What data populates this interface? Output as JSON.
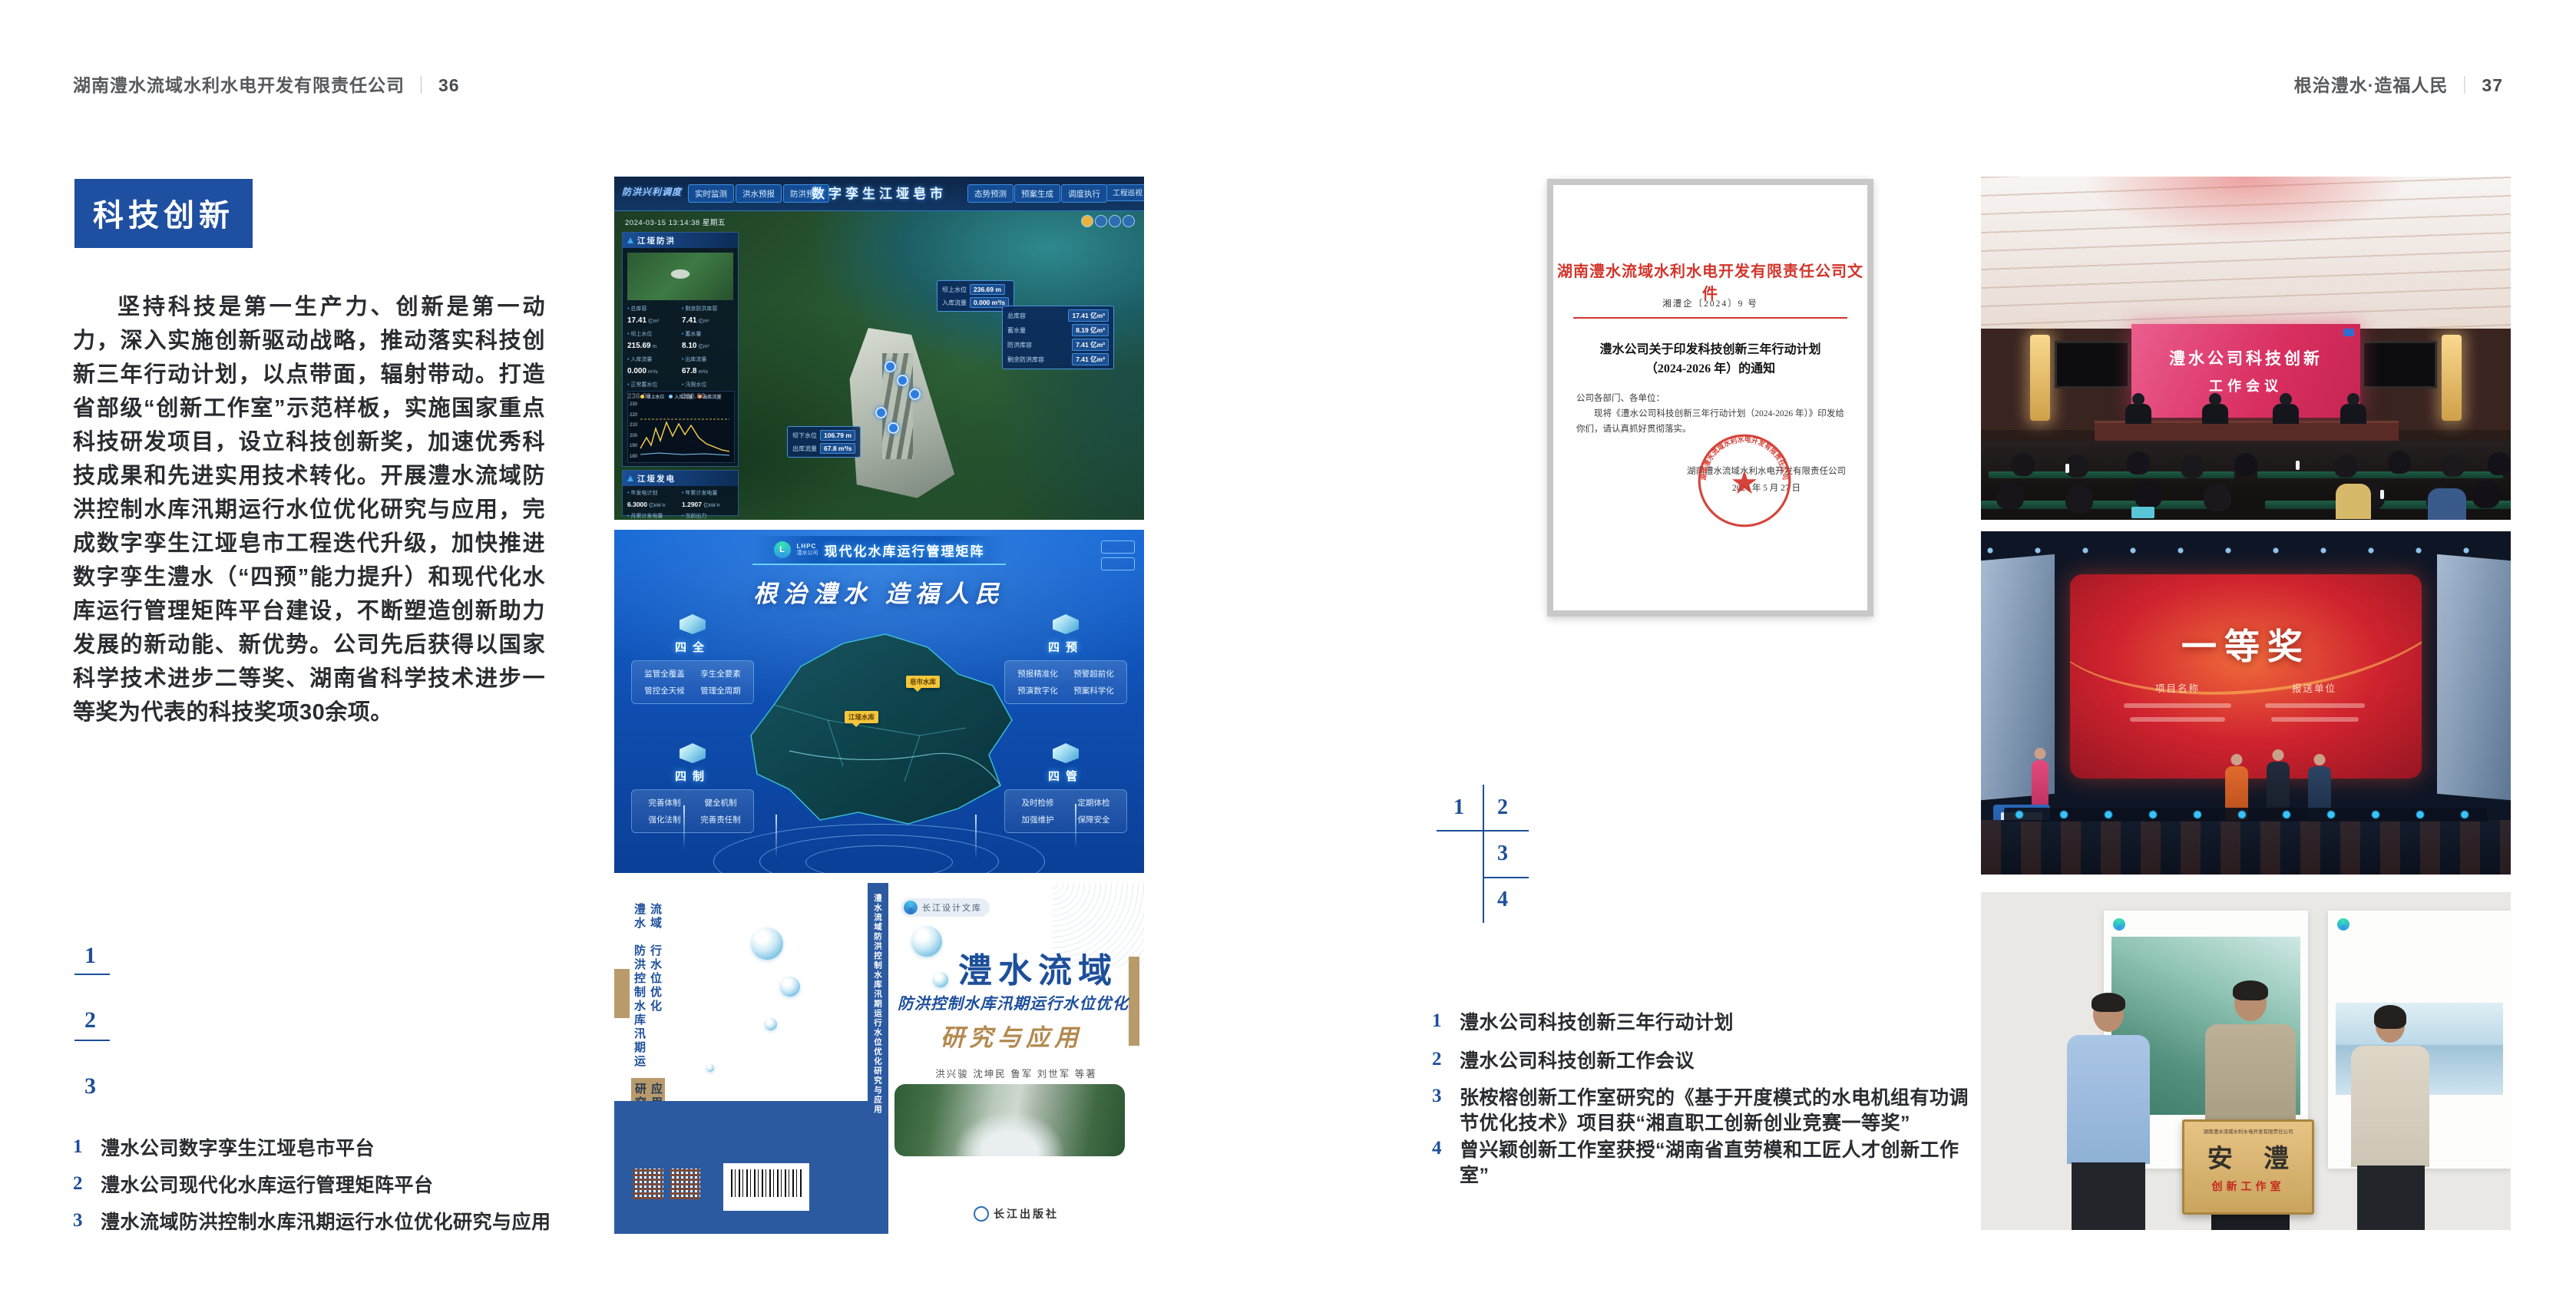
{
  "colors": {
    "accent_blue": "#1d4e99",
    "badge_blue": "#1e4fa0",
    "text_dark": "#2b2c31",
    "header_gray": "#58595b",
    "doc_red": "#d2352b",
    "gold": "#d8b26d"
  },
  "left_page": {
    "header": {
      "text": "湖南澧水流域水利水电开发有限责任公司",
      "sep": "｜",
      "page": "36"
    },
    "badge": "科技创新",
    "body": "坚持科技是第一生产力、创新是第一动力，深入实施创新驱动战略，推动落实科技创新三年行动计划，以点带面，辐射带动。打造省部级“创新工作室”示范样板，实施国家重点科技研发项目，设立科技创新奖，加速优秀科技成果和先进实用技术转化。开展澧水流域防洪控制水库汛期运行水位优化研究与应用，完成数字孪生江垭皂市工程迭代升级，加快推进数字孪生澧水（“四预”能力提升）和现代化水库运行管理矩阵平台建设，不断塑造创新助力发展的新动能、新优势。公司先后获得以国家科学技术进步二等奖、湖南省科学技术进步一等奖为代表的科技奖项30余项。",
    "figure_nums": [
      "1",
      "2",
      "3"
    ],
    "captions": [
      {
        "num": "1",
        "text": "澧水公司数字孪生江垭皂市平台"
      },
      {
        "num": "2",
        "text": "澧水公司现代化水库运行管理矩阵平台"
      },
      {
        "num": "3",
        "text": "澧水流域防洪控制水库汛期运行水位优化研究与应用"
      }
    ]
  },
  "right_page": {
    "header": {
      "text": "根治澧水·造福人民",
      "sep": "｜",
      "page": "37"
    },
    "figure_nums": [
      "1",
      "2",
      "3",
      "4"
    ],
    "captions": [
      {
        "num": "1",
        "text": "澧水公司科技创新三年行动计划"
      },
      {
        "num": "2",
        "text": "澧水公司科技创新工作会议"
      },
      {
        "num": "3",
        "text": "张桉榕创新工作室研究的《基于开度模式的水电机组有功调节优化技术》项目获“湘直职工创新创业竞赛一等奖”"
      },
      {
        "num": "4",
        "text": "曾兴颖创新工作室获授“湖南省直劳模和工匠人才创新工作室”"
      }
    ]
  },
  "fig_dashboard": {
    "corner_label": "防洪兴利调度",
    "title": "数字孪生江垭皂市",
    "tabs_left": [
      "实时监测",
      "洪水预报",
      "防洪预警"
    ],
    "tabs_right": [
      "态势预测",
      "预案生成",
      "调度执行",
      "工程巡视"
    ],
    "datetime": "2024-03-15 13:14:38 星期五",
    "panel_flood": {
      "title": "江垭防洪",
      "stats": [
        {
          "label": "总库容",
          "value": "17.41",
          "unit": "亿m³"
        },
        {
          "label": "剩余防洪库容",
          "value": "7.41",
          "unit": "亿m³"
        },
        {
          "label": "坝上水位",
          "value": "215.69",
          "unit": "m"
        },
        {
          "label": "蓄水量",
          "value": "8.10",
          "unit": "亿m³"
        },
        {
          "label": "入库流量",
          "value": "0.000",
          "unit": "m³/s"
        },
        {
          "label": "出库流量",
          "value": "67.8",
          "unit": "m³/s"
        },
        {
          "label": "正常蓄水位",
          "value": "236.00",
          "unit": "m"
        },
        {
          "label": "汛限水位",
          "value": "210.60",
          "unit": "m"
        }
      ],
      "legend": [
        "坝上水位",
        "入库流量",
        "出库流量"
      ],
      "y_ticks": [
        "230",
        "220",
        "210",
        "200",
        "190",
        "180"
      ]
    },
    "panel_power": {
      "title": "江垭发电",
      "stats": [
        {
          "label": "年发电计划",
          "value": "6.3000",
          "unit": "亿kW·h"
        },
        {
          "label": "年累计发电量",
          "value": "1.2907",
          "unit": "亿kW·h"
        },
        {
          "label": "月累计发电量",
          "value": "3359.21",
          "unit": "万kW·h"
        },
        {
          "label": "当前出力",
          "value": "0.00",
          "unit": "MW"
        }
      ]
    },
    "tag_upper": {
      "rows": [
        {
          "label": "坝上水位",
          "value": "236.69 m"
        },
        {
          "label": "入库流量",
          "value": "0.000 m³/s"
        }
      ]
    },
    "tag_lower": {
      "rows": [
        {
          "label": "坝下水位",
          "value": "106.79 m"
        },
        {
          "label": "出库流量",
          "value": "67.8 m³/s"
        }
      ]
    },
    "info_panel": [
      {
        "label": "总库容",
        "value": "17.41 亿m³"
      },
      {
        "label": "蓄水量",
        "value": "8.19 亿m³"
      },
      {
        "label": "防洪库容",
        "value": "7.41 亿m³"
      },
      {
        "label": "剩余防洪库容",
        "value": "7.41 亿m³"
      }
    ]
  },
  "fig_matrix": {
    "logo_abbr": "LHPC",
    "logo_name": "澧水公司",
    "title": "现代化水库运行管理矩阵",
    "slogan": "根治澧水 造福人民",
    "panels": [
      {
        "title": "四全",
        "items": [
          "监管全覆盖",
          "孪生全要素",
          "管控全天候",
          "管理全周期"
        ]
      },
      {
        "title": "四预",
        "items": [
          "预报精准化",
          "预警超前化",
          "预演数字化",
          "预案科学化"
        ]
      },
      {
        "title": "四制",
        "items": [
          "完善体制",
          "健全机制",
          "强化法制",
          "完善责任制"
        ]
      },
      {
        "title": "四管",
        "items": [
          "及时检修",
          "定期体检",
          "加强维护",
          "保障安全"
        ]
      }
    ],
    "map_tags": [
      "皂市水库",
      "江垭水库"
    ]
  },
  "fig_book": {
    "series": "长江设计文库",
    "title_main": "澧水流域",
    "title_sub": "防洪控制水库汛期运行水位优化",
    "title_tail": "研究与应用",
    "authors": "洪兴骏 沈坤民 鲁军 刘世军 等著",
    "publisher": "长江出版社",
    "spine": "澧水流域防洪控制水库汛期运行水位优化研究与应用",
    "back_lines": [
      "澧水流域",
      "防洪控制水库汛期运行水位优化",
      "研究与应用"
    ]
  },
  "fig_doc": {
    "header": "湖南澧水流域水利水电开发有限责任公司文件",
    "doc_no": "湘澧企〔2024〕9 号",
    "title_lines": [
      "澧水公司关于印发科技创新三年行动计划",
      "（2024-2026 年）的通知"
    ],
    "salutation": "公司各部门、各单位：",
    "body_lines": [
      "现将《澧水公司科技创新三年行动计划（2024-2026 年）》印发给你们，请认真抓好贯彻落实。"
    ],
    "sign_company": "湖南澧水流域水利水电开发有限责任公司",
    "sign_date": "2024 年 5 月 27 日",
    "seal_text": "湖南澧水流域水利水电开发有限责任公司"
  },
  "fig_meeting": {
    "screen_lines": [
      "澧水公司科技创新",
      "工作会议"
    ]
  },
  "fig_award": {
    "award": "一等奖",
    "columns": [
      "项目名称",
      "报送单位"
    ]
  },
  "fig_plaque": {
    "header": "湖南澧水流域水利水电开发有限责任公司",
    "main": "安 澧",
    "sub": "创新工作室"
  }
}
